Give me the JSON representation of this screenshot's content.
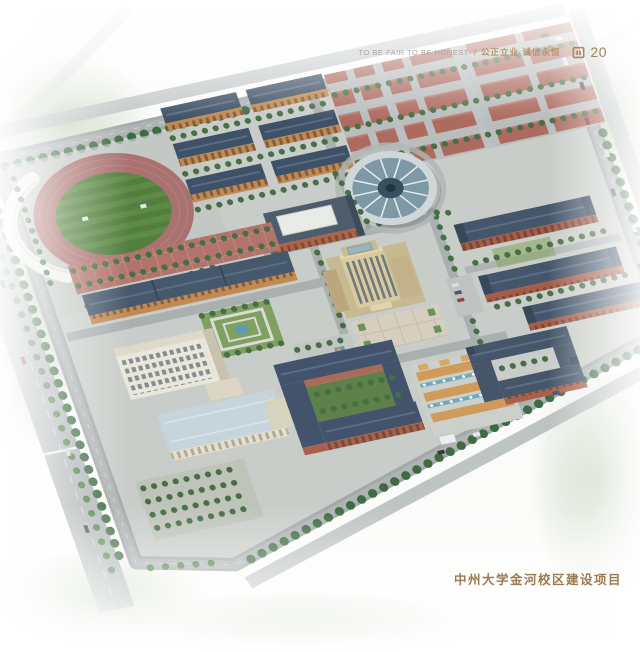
{
  "header": {
    "slogan_en": "TO BE FAIR TO BE HONEST",
    "separator": "/",
    "slogan_cn": "公正立业 诚信永恒",
    "page_number": "20"
  },
  "footer": {
    "caption": "中州大学金河校区建设项目"
  },
  "palette": {
    "accent_gold": "#ab8a5f",
    "caption_brown": "#9c7a50",
    "slogan_gray": "#a8a8a3",
    "track_red": "#a9716f",
    "field_green": "#527f3e",
    "roof_slate_blue": "#46586b",
    "brick_orange": "#c08a52",
    "brick_red": "#a65c48",
    "tower_beige": "#d8c9a0",
    "dome_glass_blue": "#7e99a6",
    "parking_red": "#ad6b60",
    "road_gray": "#a7acad",
    "water_blue": "#5d9ab8",
    "tree_green": "#3e6b42",
    "plaza_red": "#b2736b",
    "library_cream": "#e9e6da",
    "wing_roof_blue": "#c6d5dc",
    "pergola_orange": "#cf9a5a"
  },
  "scene": {
    "kind": "aerial-campus-masterplan-rendering",
    "features": [
      "stadium-running-track",
      "grandstand-canopy",
      "dormitory-cluster",
      "parking-lot",
      "gymnasium-dome",
      "dining-hall",
      "main-tower",
      "library-complex",
      "formal-garden",
      "courtyard-dormitory",
      "fountain-plaza",
      "teaching-building-cluster",
      "perimeter-roads",
      "tree-belts"
    ]
  }
}
